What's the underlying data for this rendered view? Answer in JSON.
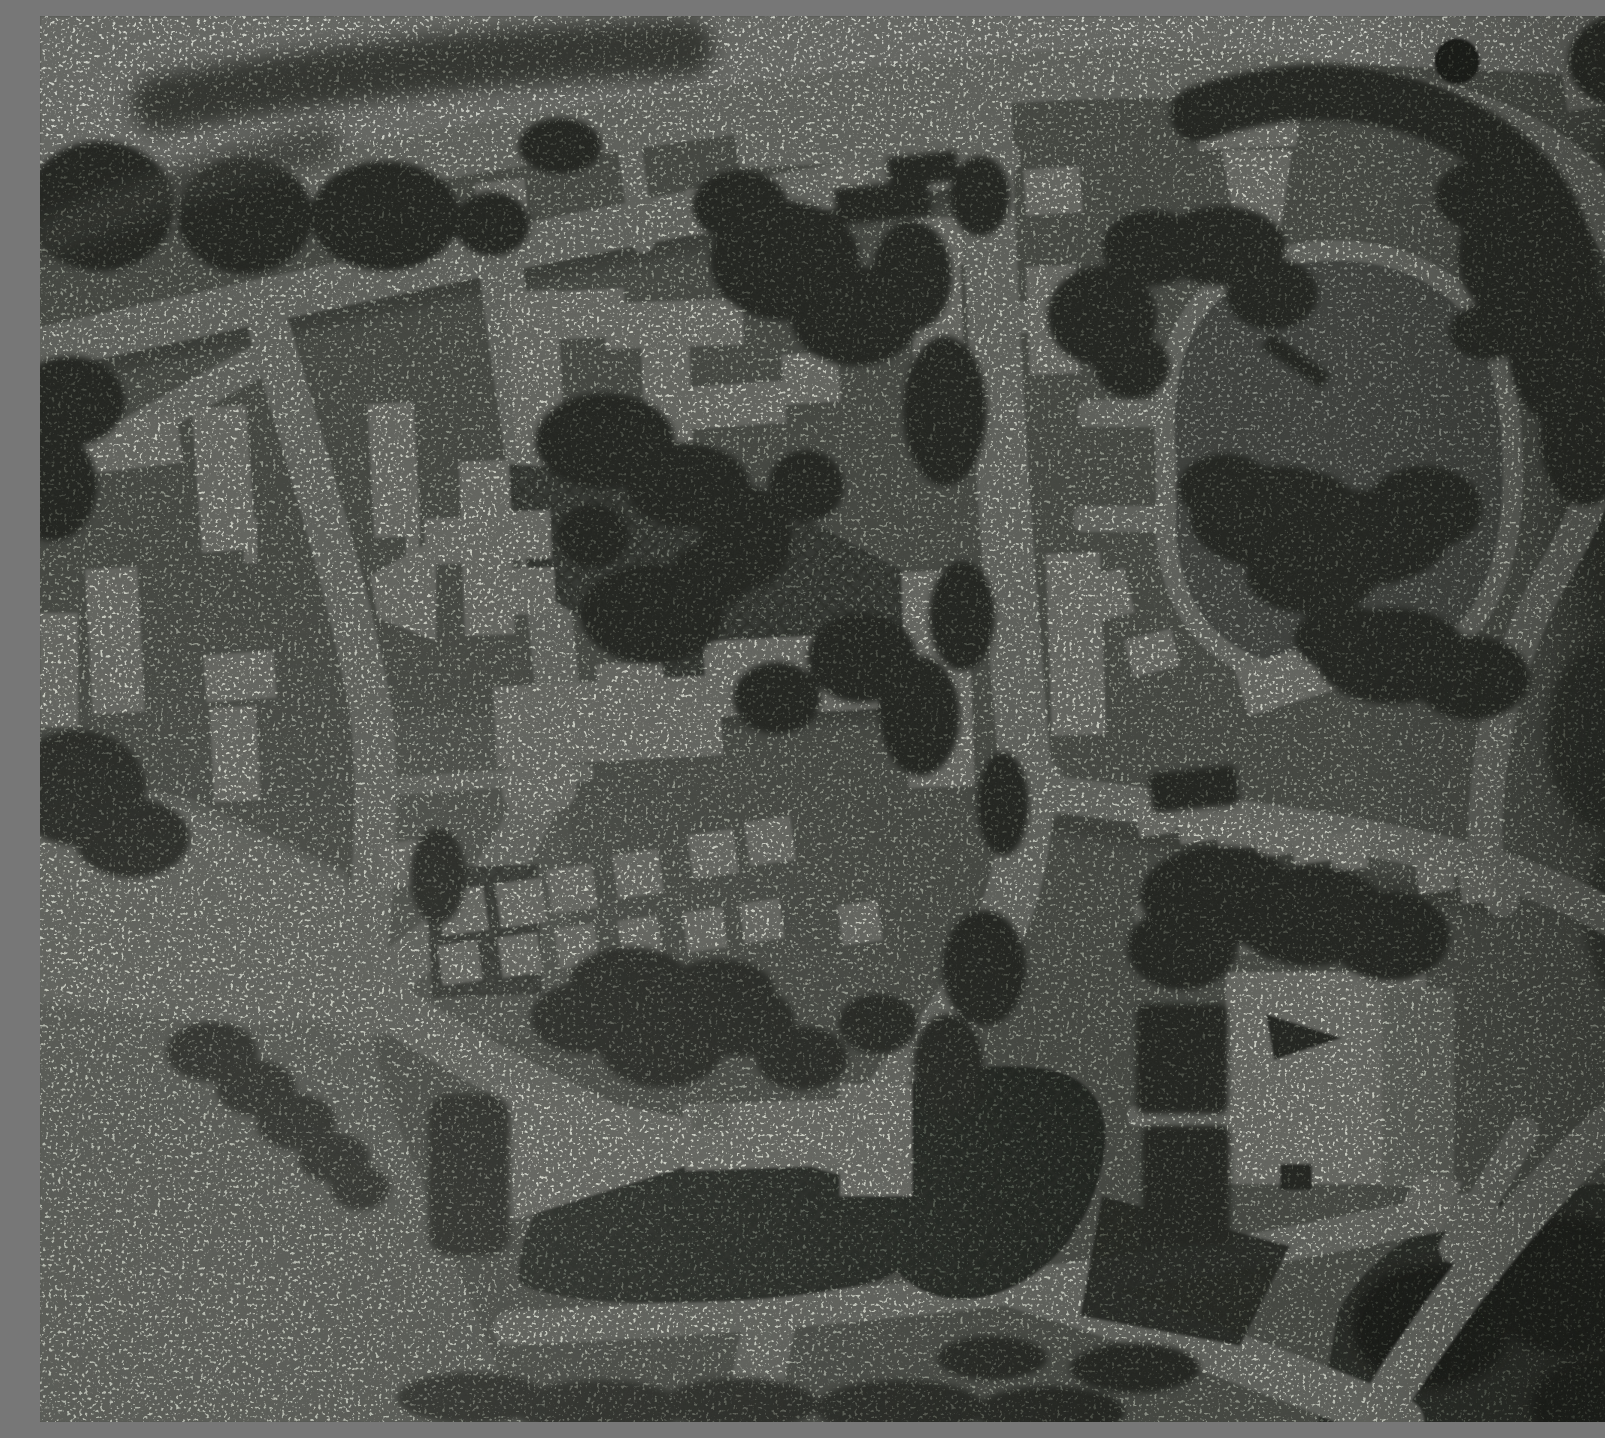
{
  "meta": {
    "kind": "halftone-photograph",
    "subject": "aerial plan view of a modernist town-planning model",
    "aria_label": "Grainy black-and-white halftone aerial photograph of an urban planning model: a tilted street grid with light slab buildings and terraced house rows, dark tree clusters, a large oval park loop road in the upper right, crosshatched ground panels in the centre and lower middle, and a bright open field at the lower left.",
    "color_mode": "grayscale with slight green-grey print tint",
    "visible_text": "none"
  },
  "palette": {
    "paper": "#cfd2c9",
    "road": "#c0c4b9",
    "bld": "#cbcec3",
    "bld2": "#b3b8ac",
    "ground": "#8a8f84",
    "field": "#a7aca1",
    "park": "#7d827a",
    "dark": "#454a40",
    "vdark": "#2f332b",
    "hedge": "#666b60",
    "hatchbg": "#6b7066",
    "hatchline": "#383d34",
    "hummock": "#3e443a",
    "hummockline": "#5b6156",
    "shadow": "#5c6157"
  },
  "scene": {
    "regions": [
      {
        "name": "top-margin",
        "description": "light speckled strip across the top with a soft dark hedge band"
      },
      {
        "name": "street-grid",
        "description": "two upper cross streets sloping up to the right, two left vertical streets, wide central vertical road, diagonal boulevard to lower right"
      },
      {
        "name": "park-loop",
        "description": "egg-shaped loop road enclosing darker parkland with large tree shadows, three stub connectors on its left"
      },
      {
        "name": "open-field",
        "description": "bright empty ground occupying the lower-left corner with a chain of dark trees"
      },
      {
        "name": "terrace-rows",
        "description": "rows of small square houses along minor lanes, left-centre and below the park"
      },
      {
        "name": "crosshatch-panels",
        "description": "three crosshatched ground panels: central block, patch left of the bowtie, two dark hummocks near the bottom"
      },
      {
        "name": "bowtie-building",
        "description": "fan-waisted long building left of centre near the bottom"
      },
      {
        "name": "large-se-building",
        "description": "big light slab with dark wedge notch, lower right of centre"
      },
      {
        "name": "round-tree-dot",
        "description": "single dark filled circle near the top-right corner"
      }
    ],
    "counts": {
      "terrace_houses_left_row_upper": 7,
      "terrace_houses_left_row_lower": 7,
      "terrace_houses_park_row": 8,
      "terrace_stubs_lower_row": 5,
      "loop_stub_connectors": 3,
      "crosshatch_panels": 4
    },
    "texture": "coarse halftone grain with scattered black speckles and overall softness"
  }
}
